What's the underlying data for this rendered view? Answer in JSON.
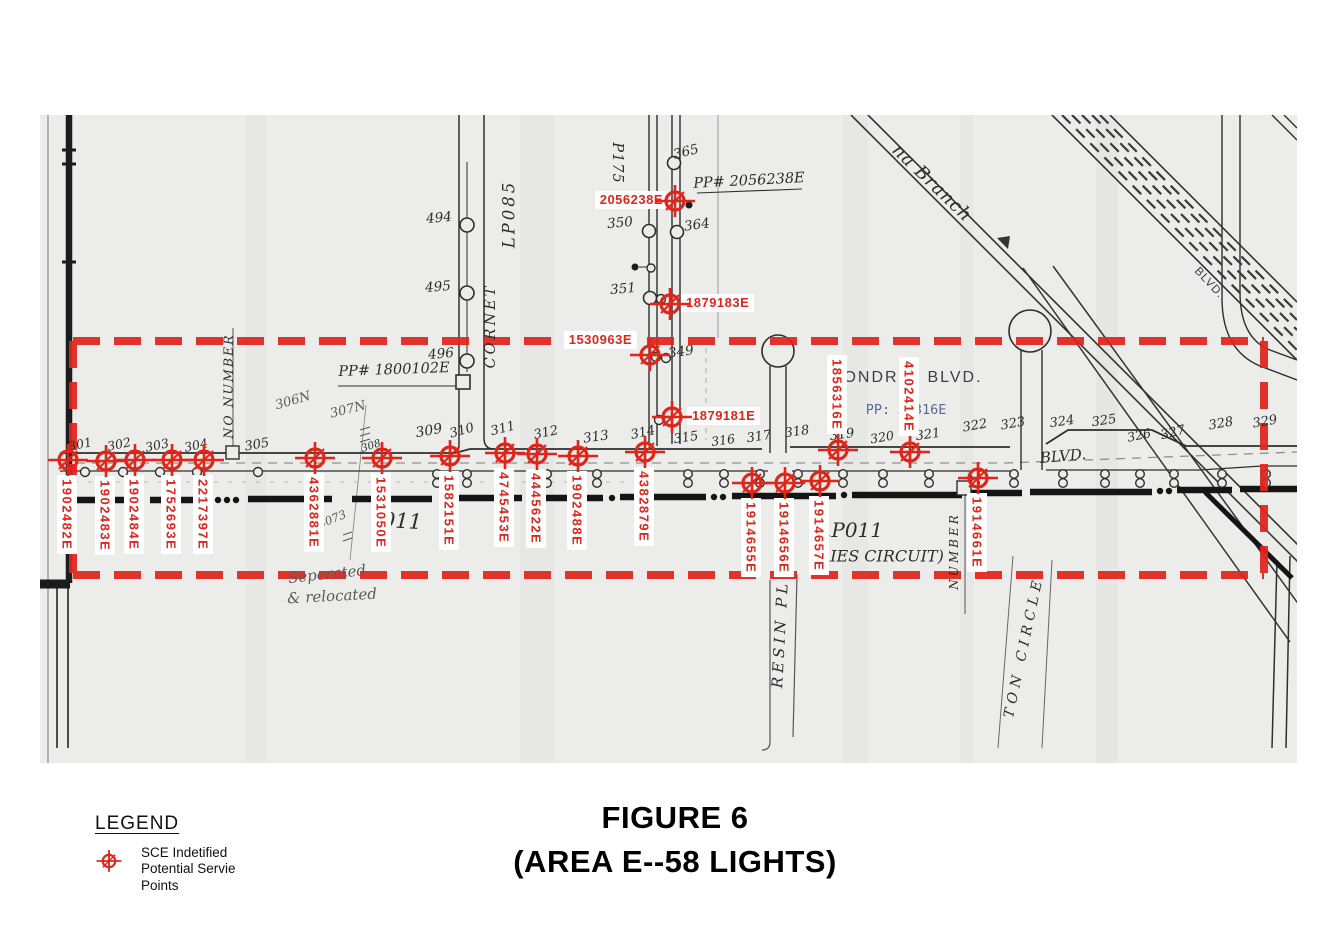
{
  "figure": {
    "title_line1": "FIGURE 6",
    "title_line2": "(AREA E--58 LIGHTS)"
  },
  "legend": {
    "title": "LEGEND",
    "symbol": "service-point-crosshair-icon",
    "lines": [
      "SCE Indetified",
      "Potential Servie",
      "Points"
    ]
  },
  "colors": {
    "annotation_red": "#e1251b",
    "paper": "#ecedeb",
    "ink": "#2d2d2d",
    "pencil": "#5a5a5a",
    "typed_blue": "#5a6a92"
  },
  "highlight_box": {
    "x": 73,
    "y": 341,
    "width": 1191,
    "height": 234,
    "style": "dashed",
    "color": "#e1251b"
  },
  "map": {
    "service_points": [
      {
        "id": "1902482E",
        "x": 68,
        "y": 460,
        "lp": "below"
      },
      {
        "id": "1902483E",
        "x": 106,
        "y": 461,
        "lp": "below"
      },
      {
        "id": "1902484E",
        "x": 135,
        "y": 460,
        "lp": "below"
      },
      {
        "id": "1752693E",
        "x": 172,
        "y": 460,
        "lp": "below"
      },
      {
        "id": "2217397E",
        "x": 204,
        "y": 460,
        "lp": "below"
      },
      {
        "id": "4362881E",
        "x": 315,
        "y": 458,
        "lp": "below"
      },
      {
        "id": "1531050E",
        "x": 382,
        "y": 458,
        "lp": "below"
      },
      {
        "id": "1582151E",
        "x": 450,
        "y": 456,
        "lp": "below"
      },
      {
        "id": "4745453E",
        "x": 505,
        "y": 453,
        "lp": "below"
      },
      {
        "id": "4445622E",
        "x": 537,
        "y": 454,
        "lp": "below"
      },
      {
        "id": "1902488E",
        "x": 578,
        "y": 456,
        "lp": "below"
      },
      {
        "id": "4382879E",
        "x": 645,
        "y": 452,
        "lp": "below"
      },
      {
        "id": "1914655E",
        "x": 752,
        "y": 483,
        "lp": "below"
      },
      {
        "id": "1914656E",
        "x": 785,
        "y": 483,
        "lp": "below"
      },
      {
        "id": "1914657E",
        "x": 820,
        "y": 481,
        "lp": "below"
      },
      {
        "id": "1914661E",
        "x": 978,
        "y": 478,
        "lp": "below"
      },
      {
        "id": "1856316E",
        "x": 838,
        "y": 450,
        "lp": "above"
      },
      {
        "id": "4102414E",
        "x": 910,
        "y": 452,
        "lp": "above"
      },
      {
        "id": "2056238E",
        "x": 675,
        "y": 201,
        "lp": "left",
        "dx": 1
      },
      {
        "id": "1879183E",
        "x": 670,
        "y": 304,
        "lp": "right"
      },
      {
        "id": "1530963E",
        "x": 650,
        "y": 355,
        "lp": "left",
        "dx": -5,
        "dy": -14
      },
      {
        "id": "1879181E",
        "x": 672,
        "y": 417,
        "lp": "right",
        "dx": 4
      }
    ],
    "texts": [
      {
        "t": "301",
        "x": 80,
        "y": 444,
        "r": -12,
        "s": 12.5,
        "c": "hw"
      },
      {
        "t": "302",
        "x": 119,
        "y": 444,
        "r": -12,
        "s": 12.5,
        "c": "hw"
      },
      {
        "t": "303",
        "x": 157,
        "y": 445,
        "r": -12,
        "s": 12.5,
        "c": "hw"
      },
      {
        "t": "304",
        "x": 196,
        "y": 445,
        "r": -12,
        "s": 12.5,
        "c": "hw"
      },
      {
        "t": "305",
        "x": 257,
        "y": 445,
        "r": -10,
        "s": 13,
        "c": "hw"
      },
      {
        "t": "308",
        "x": 371,
        "y": 446,
        "r": -18,
        "s": 10.5,
        "c": "hw"
      },
      {
        "t": "309",
        "x": 429,
        "y": 431,
        "r": -10,
        "s": 14,
        "c": "hw"
      },
      {
        "t": "310",
        "x": 462,
        "y": 431,
        "r": -16,
        "s": 13,
        "c": "hw"
      },
      {
        "t": "311",
        "x": 503,
        "y": 429,
        "r": -14,
        "s": 13,
        "c": "hw"
      },
      {
        "t": "312",
        "x": 546,
        "y": 433,
        "r": -12,
        "s": 13,
        "c": "hw"
      },
      {
        "t": "313",
        "x": 596,
        "y": 437,
        "r": -8,
        "s": 13.5,
        "c": "hw"
      },
      {
        "t": "314",
        "x": 643,
        "y": 433,
        "r": -12,
        "s": 13,
        "c": "hw"
      },
      {
        "t": "315",
        "x": 686,
        "y": 438,
        "r": -8,
        "s": 13,
        "c": "hw"
      },
      {
        "t": "316",
        "x": 723,
        "y": 440,
        "r": -8,
        "s": 12.5,
        "c": "hw"
      },
      {
        "t": "317",
        "x": 759,
        "y": 437,
        "r": -8,
        "s": 13,
        "c": "hw"
      },
      {
        "t": "318",
        "x": 797,
        "y": 432,
        "r": -8,
        "s": 13,
        "c": "hw"
      },
      {
        "t": "319",
        "x": 842,
        "y": 435,
        "r": -8,
        "s": 13,
        "c": "hw"
      },
      {
        "t": "320",
        "x": 882,
        "y": 437,
        "r": -10,
        "s": 12.5,
        "c": "hw"
      },
      {
        "t": "321",
        "x": 928,
        "y": 435,
        "r": -8,
        "s": 13,
        "c": "hw"
      },
      {
        "t": "322",
        "x": 975,
        "y": 426,
        "r": -10,
        "s": 13,
        "c": "hw"
      },
      {
        "t": "323",
        "x": 1013,
        "y": 424,
        "r": -10,
        "s": 13,
        "c": "hw"
      },
      {
        "t": "324",
        "x": 1062,
        "y": 422,
        "r": -8,
        "s": 13,
        "c": "hw"
      },
      {
        "t": "325",
        "x": 1104,
        "y": 421,
        "r": -8,
        "s": 13,
        "c": "hw"
      },
      {
        "t": "326",
        "x": 1139,
        "y": 435,
        "r": -12,
        "s": 12.5,
        "c": "hw"
      },
      {
        "t": "327",
        "x": 1173,
        "y": 433,
        "r": -14,
        "s": 13,
        "c": "hw"
      },
      {
        "t": "328",
        "x": 1221,
        "y": 424,
        "r": -10,
        "s": 13,
        "c": "hw"
      },
      {
        "t": "329",
        "x": 1265,
        "y": 422,
        "r": -10,
        "s": 13,
        "c": "hw"
      },
      {
        "t": "349",
        "x": 681,
        "y": 352,
        "r": -8,
        "s": 13.5,
        "c": "hw"
      },
      {
        "t": "350",
        "x": 620,
        "y": 223,
        "r": -5,
        "s": 13.5,
        "c": "hw"
      },
      {
        "t": "351",
        "x": 623,
        "y": 289,
        "r": -5,
        "s": 13.5,
        "c": "hw"
      },
      {
        "t": "364",
        "x": 697,
        "y": 225,
        "r": -8,
        "s": 13.5,
        "c": "hw"
      },
      {
        "t": "365",
        "x": 686,
        "y": 152,
        "r": -14,
        "s": 13.5,
        "c": "hw"
      },
      {
        "t": "494",
        "x": 439,
        "y": 218,
        "r": -5,
        "s": 13.5,
        "c": "hw"
      },
      {
        "t": "495",
        "x": 438,
        "y": 287,
        "r": -5,
        "s": 13.5,
        "c": "hw"
      },
      {
        "t": "496",
        "x": 441,
        "y": 354,
        "r": -5,
        "s": 13.5,
        "c": "hw"
      },
      {
        "t": "PP# 2056238E",
        "x": 749,
        "y": 181,
        "r": -3,
        "s": 14.5,
        "c": "hw"
      },
      {
        "t": "PP# 1800102E",
        "x": 394,
        "y": 370,
        "r": -2,
        "s": 14.5,
        "c": "hw"
      },
      {
        "t": "011",
        "x": 402,
        "y": 521,
        "r": 3,
        "s": 21,
        "c": "hw"
      },
      {
        "t": ".P011",
        "x": 854,
        "y": 530,
        "r": 0,
        "s": 20,
        "c": "hw"
      },
      {
        "t": "RIES CIRCUIT)",
        "x": 881,
        "y": 556,
        "r": 0,
        "s": 16,
        "c": "hw"
      },
      {
        "t": "BLVD.",
        "x": 1063,
        "y": 456,
        "r": -5,
        "s": 15,
        "c": "hw"
      },
      {
        "t": "306N",
        "x": 293,
        "y": 401,
        "r": -16,
        "s": 13,
        "c": "pencil"
      },
      {
        "t": "307N",
        "x": 348,
        "y": 410,
        "r": -14,
        "s": 13,
        "c": "pencil"
      },
      {
        "t": "3073",
        "x": 332,
        "y": 519,
        "r": -22,
        "s": 11.5,
        "c": "pencil"
      },
      {
        "t": "Seperated",
        "x": 327,
        "y": 574,
        "r": -6,
        "s": 15,
        "c": "pencil"
      },
      {
        "t": "& relocated",
        "x": 332,
        "y": 596,
        "r": -3,
        "s": 15,
        "c": "pencil"
      },
      {
        "t": "NO NUMBER",
        "x": 228,
        "y": 386,
        "r": -90,
        "s": 12.5,
        "c": "hw",
        "ls": 2
      },
      {
        "t": "NUMBER",
        "x": 954,
        "y": 551,
        "r": -90,
        "s": 12,
        "c": "hw",
        "ls": 3
      },
      {
        "t": "RESIN PL",
        "x": 780,
        "y": 634,
        "r": -87,
        "s": 15,
        "c": "hw",
        "ls": 4
      },
      {
        "t": "TON CIRCLE",
        "x": 1024,
        "y": 647,
        "r": -78,
        "s": 14,
        "c": "hw",
        "ls": 5
      },
      {
        "t": "CORNET",
        "x": 491,
        "y": 326,
        "r": -90,
        "s": 14.5,
        "c": "hw",
        "ls": 3
      },
      {
        "t": "LP085",
        "x": 509,
        "y": 214,
        "r": -90,
        "s": 16.5,
        "c": "hw",
        "ls": 3
      },
      {
        "t": "P175",
        "x": 617,
        "y": 163,
        "r": 90,
        "s": 14.5,
        "c": "hw",
        "ls": 1
      },
      {
        "t": "na Branch",
        "x": 932,
        "y": 183,
        "r": 44,
        "s": 18,
        "c": "hw",
        "ls": 1
      },
      {
        "t": "BLVD.",
        "x": 1209,
        "y": 283,
        "r": 47,
        "s": 11.5,
        "c": "typed",
        "ls": 1
      },
      {
        "t": "ONDR",
        "x": 871,
        "y": 378,
        "r": 0,
        "s": 16,
        "c": "typed",
        "ls": 2
      },
      {
        "t": "BLVD.",
        "x": 955,
        "y": 378,
        "r": 0,
        "s": 16,
        "c": "typed",
        "ls": 2
      },
      {
        "t": "PP:",
        "x": 878,
        "y": 410,
        "r": 0,
        "s": 13.5,
        "c": "blue"
      },
      {
        "t": "58316E",
        "x": 922,
        "y": 410,
        "r": 0,
        "s": 13.5,
        "c": "blue"
      }
    ]
  }
}
